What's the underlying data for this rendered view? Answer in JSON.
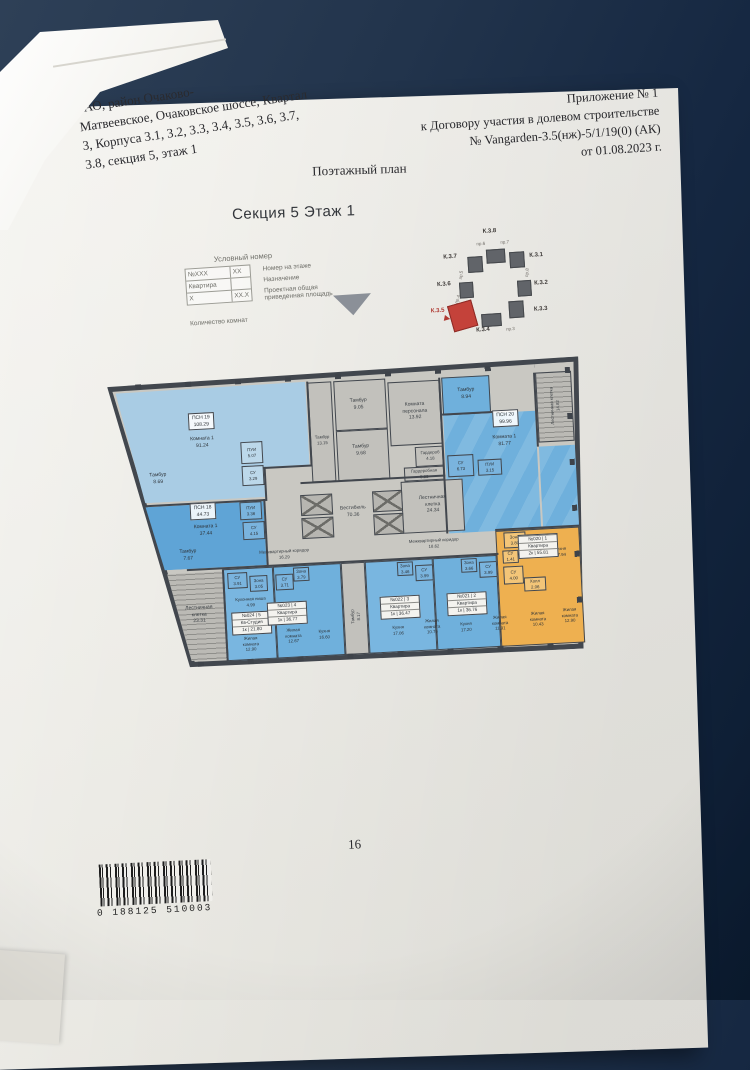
{
  "page": {
    "address_lines": [
      "ЗАО, район Очаково-",
      "Матвеевское, Очаковское шоссе, Квартал",
      "3, Корпуса 3.1, 3.2, 3.3, 3.4, 3.5, 3.6, 3.7,",
      "3.8, секция 5, этаж 1"
    ],
    "appendix_lines": [
      "Приложение № 1",
      "к Договору участия в долевом строительстве",
      "№ Vangarden-3.5(нж)-5/1/19(0) (АК)",
      "от 01.08.2023 г."
    ],
    "plan_title": "Поэтажный план",
    "section_title": "Секция 5 Этаж 1",
    "page_number": "16",
    "barcode_text": "0 188125 510003"
  },
  "legend": {
    "title": "Условный номер",
    "cell_number": "№XXX",
    "cell_floor": "XX",
    "cell_purpose": "Квартира",
    "cell_rooms": "X",
    "cell_area": "XX.X",
    "label_number": "Номер на этаже",
    "label_purpose": "Назначение",
    "label_area": [
      "Проектная общая",
      "приведенная площадь"
    ],
    "label_rooms": "Количество комнат"
  },
  "key_plan": {
    "buildings": {
      "k31": "К.3.1",
      "k32": "К.3.2",
      "k33": "К.3.3",
      "k34": "К.3.4",
      "k35": "К.3.5",
      "k36": "К.3.6",
      "k37": "К.3.7",
      "k38": "К.3.8"
    },
    "passages": {
      "pr3": "пр.3",
      "pr4": "пр.4",
      "pr5": "пр.5",
      "pr6": "пр.6",
      "pr7": "пр.7",
      "pr8": "пр.8"
    },
    "highlighted": "К.3.5"
  },
  "floor_plan": {
    "labels": {
      "tambur_905": [
        "Тамбур",
        "9.05"
      ],
      "tambur_1315": [
        "Тамбур",
        "13.15"
      ],
      "tambur_968": [
        "Тамбур",
        "9.68"
      ],
      "komnata_personala": [
        "Комната",
        "персонала",
        "13.92"
      ],
      "garderob": [
        "Гардероб",
        "4.18"
      ],
      "garderobnaya": [
        "Гардеробная",
        "5.33"
      ],
      "vestibul": [
        "Вестибюль",
        "70.36"
      ],
      "lk_2434": [
        "Лестничная",
        "клетка",
        "24.34"
      ],
      "lk_2331": [
        "Лестничная",
        "клетка",
        "23.31"
      ],
      "lk_1482": [
        "Лестничная клетка",
        "14.82"
      ],
      "mk_left": [
        "Межквартирный коридор",
        "16.29"
      ],
      "mk_right": [
        "Межквартирный коридор",
        "18.62"
      ],
      "tambur_817": [
        "Тамбур",
        "8.17"
      ],
      "psn19": [
        "ПСН 19",
        "108.29"
      ],
      "psn19_room": [
        "Комната 1",
        "91.24"
      ],
      "psn19_tambur": [
        "Тамбур",
        "8.69"
      ],
      "psn19_pui": [
        "ПУИ",
        "5.07"
      ],
      "psn19_su": [
        "СУ",
        "3.29"
      ],
      "psn18": [
        "ПСН 18",
        "44.73"
      ],
      "psn18_room": [
        "Комната 1",
        "37.44"
      ],
      "psn18_tambur": [
        "Тамбур",
        "7.67"
      ],
      "psn18_pui": [
        "ПУИ",
        "3.36"
      ],
      "psn18_su": [
        "СУ",
        "4.15"
      ],
      "psn20": [
        "ПСН 20",
        "99.96"
      ],
      "psn20_room": [
        "Комната 1",
        "81.77"
      ],
      "psn20_tambur": [
        "Тамбур",
        "8.94"
      ],
      "psn20_su": [
        "СУ",
        "6.73"
      ],
      "psn20_pui": [
        "ПУИ",
        "3.15"
      ],
      "u024_su": [
        "СУ",
        "3.91"
      ],
      "u024_zona": [
        "Зона",
        "3.05"
      ],
      "u024_niche": [
        "Кухонная ниша",
        "4.99"
      ],
      "u024_room": [
        "Жилая",
        "комната",
        "12.90"
      ],
      "u023_su": [
        "СУ",
        "3.71"
      ],
      "u023_zona": [
        "Зона",
        "3.79"
      ],
      "u023_room": [
        "Жилая",
        "комната",
        "12.67"
      ],
      "u023_kitchen": [
        "Кухня",
        "16.60"
      ],
      "u022_zona": [
        "Зона",
        "3.46"
      ],
      "u022_su": [
        "СУ",
        "3.99"
      ],
      "u022_kitchen": [
        "Кухня",
        "17.06"
      ],
      "u022_room": [
        "Жилая",
        "комната",
        "10.76"
      ],
      "u021_zona": [
        "Зона",
        "3.66"
      ],
      "u021_su": [
        "СУ",
        "3.99"
      ],
      "u021_kitchen": [
        "Кухня",
        "17.20"
      ],
      "u021_room": [
        "Жилая",
        "комната",
        "11.91"
      ],
      "u020_zona": [
        "Зона",
        "3.80"
      ],
      "u020_su1": [
        "СУ",
        "1.41"
      ],
      "u020_su2": [
        "СУ",
        "4.00"
      ],
      "u020_hall": [
        "Холл",
        "2.06"
      ],
      "u020_kitchen": [
        "Кухня",
        "17.94"
      ],
      "u020_room1": [
        "Жилая",
        "комната",
        "10.43"
      ],
      "u020_room2": [
        "Жилая",
        "комната",
        "12.90"
      ]
    },
    "units": {
      "u020": [
        "№020 | 1",
        "Квартира",
        "2к | 55.81"
      ],
      "u021": [
        "№021 | 2",
        "Квартира",
        "1к | 36.76"
      ],
      "u022": [
        "№022 | 3",
        "Квартира",
        "1к | 36.47"
      ],
      "u023": [
        "№023 | 4",
        "Квартира",
        "1к | 36.77"
      ],
      "u024": [
        "№024 | 5",
        "Кв-Студия",
        "1к | 21.80"
      ]
    }
  }
}
